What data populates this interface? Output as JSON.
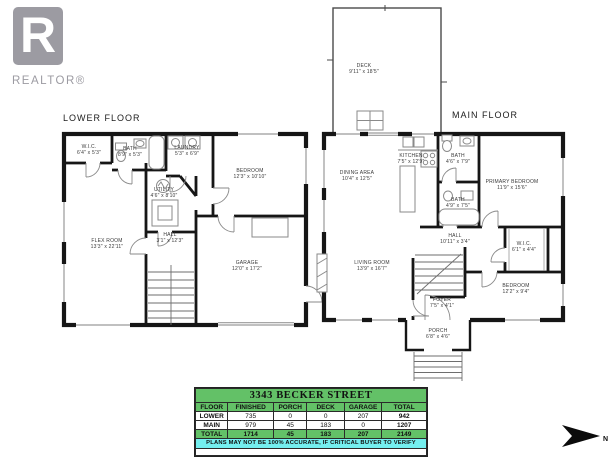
{
  "logo": {
    "brand": "REALTOR®"
  },
  "floors": {
    "lower": {
      "title": "LOWER FLOOR",
      "rooms": {
        "wic": {
          "name": "W.I.C.",
          "dims": "6'4\" x 5'3\""
        },
        "bath": {
          "name": "BATH",
          "dims": "8'9\" x 5'3\""
        },
        "laundry": {
          "name": "LAUNDRY",
          "dims": "5'3\" x 6'9\""
        },
        "bedroom": {
          "name": "BEDROOM",
          "dims": "12'3\" x 10'10\""
        },
        "utility": {
          "name": "UTILITY",
          "dims": "4'6\" x 8'10\""
        },
        "flex": {
          "name": "FLEX ROOM",
          "dims": "13'3\" x 22'11\""
        },
        "hall": {
          "name": "HALL",
          "dims": "3'1\" x 12'3\""
        },
        "garage": {
          "name": "GARAGE",
          "dims": "12'0\" x 17'2\""
        }
      }
    },
    "main": {
      "title": "MAIN FLOOR",
      "rooms": {
        "deck": {
          "name": "DECK",
          "dims": "9'11\" x 18'5\""
        },
        "dining": {
          "name": "DINING AREA",
          "dims": "10'4\" x 12'5\""
        },
        "kitchen": {
          "name": "KITCHEN",
          "dims": "7'5\" x 12'9\""
        },
        "bath1": {
          "name": "BATH",
          "dims": "4'6\" x 7'9\""
        },
        "primary": {
          "name": "PRIMARY BEDROOM",
          "dims": "11'9\" x 15'6\""
        },
        "bath2": {
          "name": "BATH",
          "dims": "4'9\" x 7'5\""
        },
        "hall": {
          "name": "HALL",
          "dims": "10'11\" x 3'4\""
        },
        "wic": {
          "name": "W.I.C.",
          "dims": "6'1\" x 4'4\""
        },
        "living": {
          "name": "LIVING ROOM",
          "dims": "13'9\" x 16'7\""
        },
        "bedroom": {
          "name": "BEDROOM",
          "dims": "12'2\" x 9'4\""
        },
        "foyer": {
          "name": "FOYER",
          "dims": "7'5\" x 4'1\""
        },
        "porch": {
          "name": "PORCH",
          "dims": "6'8\" x 4'6\""
        }
      }
    }
  },
  "area_table": {
    "title": "3343 BECKER STREET",
    "headers": [
      "FLOOR",
      "FINISHED",
      "PORCH",
      "DECK",
      "GARAGE",
      "TOTAL"
    ],
    "rows": [
      [
        "LOWER",
        "735",
        "0",
        "0",
        "207",
        "942"
      ],
      [
        "MAIN",
        "979",
        "45",
        "183",
        "0",
        "1207"
      ],
      [
        "TOTAL",
        "1714",
        "45",
        "183",
        "207",
        "2149"
      ]
    ],
    "disclaimer": "PLANS MAY NOT BE 100% ACCURATE, IF CRITICAL BUYER TO VERIFY"
  },
  "north_arrow": {
    "label": "N"
  },
  "colors": {
    "table_green": "#63c167",
    "table_cyan": "#74efef",
    "logo_gray": "#9c9ba2"
  }
}
